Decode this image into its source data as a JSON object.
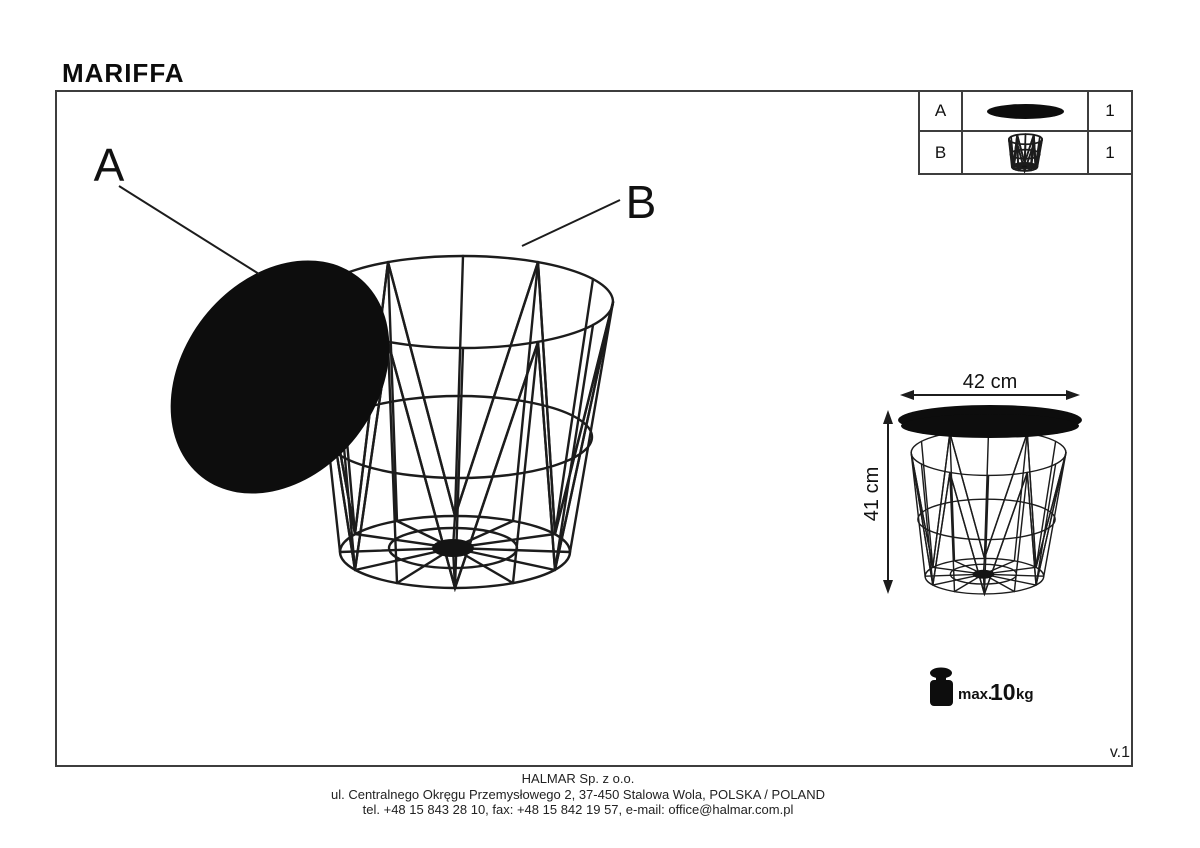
{
  "title": "MARIFFA",
  "version": "v.1",
  "parts_table": {
    "rows": [
      {
        "id": "A",
        "qty": "1",
        "icon": "solid-oval-lid-icon"
      },
      {
        "id": "B",
        "qty": "1",
        "icon": "wire-basket-icon"
      }
    ]
  },
  "diagram": {
    "label_a": "A",
    "label_b": "B"
  },
  "dimensions": {
    "width_label": "42 cm",
    "height_label": "41 cm"
  },
  "load": {
    "prefix": "max.",
    "value": "10",
    "unit": "kg",
    "icon": "weight-kettlebell-icon"
  },
  "footer": {
    "company": "HALMAR Sp. z o.o.",
    "address": "ul. Centralnego Okręgu Przemysłowego 2, 37-450 Stalowa Wola, POLSKA / POLAND",
    "contact": "tel. +48 15 843 28 10, fax: +48 15 842 19 57, e-mail: office@halmar.com.pl"
  },
  "colors": {
    "ink": "#1c1c1c",
    "frame": "#3d3d3d",
    "background": "#ffffff"
  }
}
